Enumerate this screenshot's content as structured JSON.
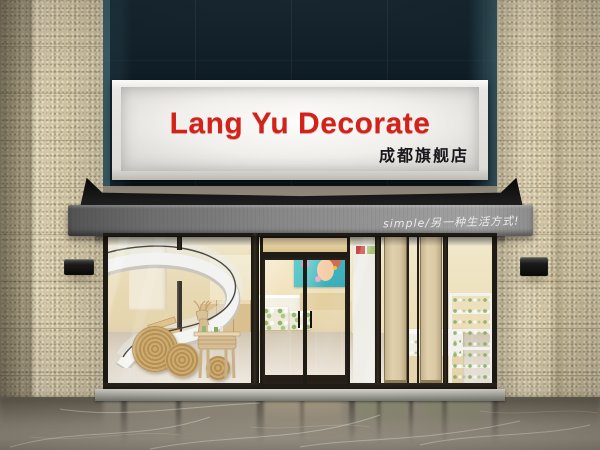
{
  "sign": {
    "title": "Lang Yu Decorate",
    "branch": "成都旗舰店",
    "title_color": "#d3221a",
    "panel_color": "#f3f1ee",
    "frame_color": "#e5e3de"
  },
  "awning": {
    "slogan": "simple/另一种生活方式!",
    "slogan_color": "#ebebeb",
    "canopy_color": "#101010",
    "valance_color": "#8e8e8e"
  },
  "facade": {
    "upper_wall_color": "#0e1c25",
    "stone_color": "#cfc2a1",
    "wall_lamp_color": "#141414"
  },
  "storefront": {
    "frame_color": "#241f19",
    "interior_wall_color": "#ecdbb2",
    "left_window_items": [
      "spiral-staircase",
      "wooden-deer-display-table",
      "woven-rope-discs",
      "backlit-product-shelves"
    ],
    "door_items": [
      "double-glass-door",
      "beauty-poster",
      "cashier-counter",
      "green-product-display-tables"
    ],
    "right_window_items": [
      "white-wall-shelf",
      "wood-piers",
      "product-display-cabinets",
      "white-etagere-shelves",
      "backlit-shelf-wall"
    ]
  },
  "ground": {
    "floor_color": "#8d8678",
    "threshold_color": "#a9a9a1"
  }
}
